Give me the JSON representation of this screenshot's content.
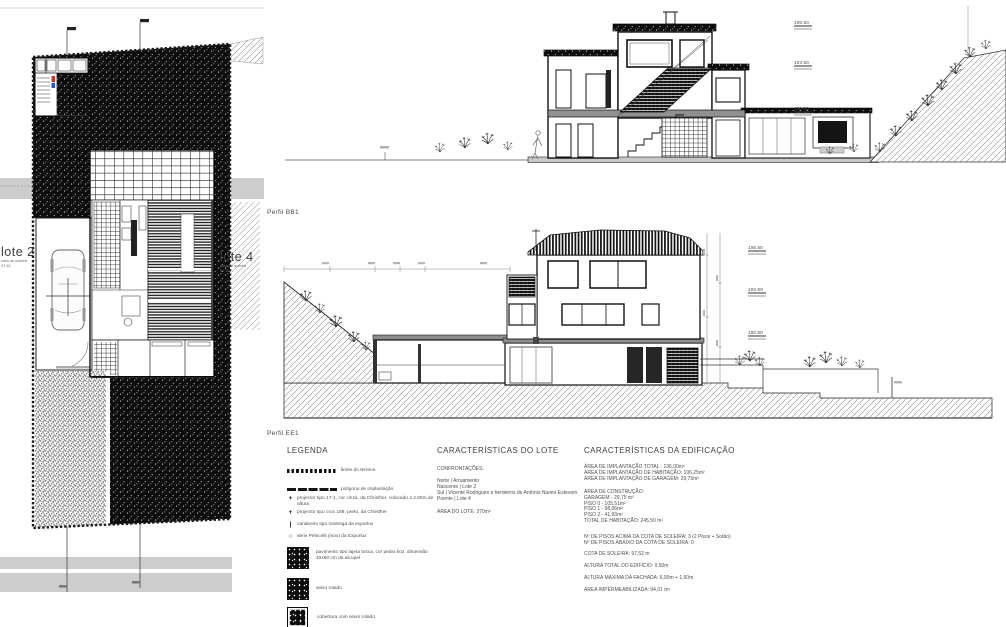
{
  "site_plan": {
    "lote2": {
      "label": "lote 2",
      "sub": "cota de soleira",
      "cota": "97,61"
    },
    "lote4": {
      "label": "lote 4",
      "sub": "cota de soleira",
      "cota": "97,32"
    }
  },
  "profiles": {
    "bb1_label": "Perfil BB1",
    "ee1_label": "Perfil EE1",
    "levels": [
      "106.50",
      "103.50",
      "100.50"
    ]
  },
  "legend": {
    "title": "LEGENDA",
    "items": [
      {
        "symbol": "dashed-line",
        "text": "limite do terreno"
      },
      {
        "symbol": "solid-line",
        "text": "polígono de implantação"
      },
      {
        "symbol": "cross",
        "glyph": "+",
        "text": "projector tipo 17-1, cor cinza, da Christher, colocado a 2.50m de altura"
      },
      {
        "symbol": "cross",
        "glyph": "+",
        "text": "projector tipo croc 188, preto, da Christher"
      },
      {
        "symbol": "bar",
        "glyph": "|",
        "text": "candeeiro tipo mintrega da exporlux"
      },
      {
        "symbol": "circle",
        "glyph": "○",
        "text": "série Pénicelli (inox) da Exporlux"
      },
      {
        "symbol": "stipple-swatch",
        "text": "pavimento tipo lajeta tosca, cor pedra lioz, dimensão 40x60 cm da alcupel"
      },
      {
        "symbol": "stipple-swatch",
        "text": "seixo rolado"
      },
      {
        "symbol": "stipple-swatch-bordered",
        "text": "cobertura com seixo rolado"
      }
    ]
  },
  "lote": {
    "title": "CARACTERÍSTICAS DO LOTE",
    "confrontacoes_label": "CONFRONTAÇÕES:",
    "confrontacoes": [
      "Norte | Arruamento",
      "Nascente | Lote 2",
      "Sul | Vicente Rodrigues e  herdeiros de António Nunes Estevam",
      "Poente | Lote 4"
    ],
    "area": "ÁREA DO LOTE: 370m²"
  },
  "edificacao": {
    "title": "CARACTERÍSTICAS DA EDIFICAÇÃO",
    "implantacao": [
      "ÁREA DE IMPLANTAÇÃO TOTAL : 136,00m²",
      "ÁREA DE IMPLANTAÇÃO DE HABITAÇÃO: 106,25m²",
      "ÁREA DE IMPLANTAÇÃO DE GARAGEM: 29,75m²"
    ],
    "construcao_label": "ÁREA DE CONSTRUÇÃO:",
    "construcao": [
      "GARAGEM - 29,75 m²",
      "PISO 0 - 105,51m²",
      "PISO 1 - 98,06m²",
      "PISO 2 - 41,93m²",
      "TOTAL DE HABITAÇÃO: 245,50 m²"
    ],
    "pisos": [
      "Nº DE PISOS ACIMA DA COTA DE SOLEIRA: 3 (2 Pisos + Sotão)",
      "Nº DE PISOS ABAIXO DA COTA DE SOLEIRA: 0"
    ],
    "cota": "COTA DE SOLEIRA: 97,52 m",
    "altura_total": "ALTURA TOTAL DO EDIFÍCIO: 9,50m",
    "altura_fachada": "ALTURA MÁXIMA DA FACHADA: 6,90m + 1,60m",
    "impermeabilizada": "ÁREA IMPERMEABILIZADA: 94,01 m²"
  },
  "colors": {
    "ink": "#111111",
    "slab_gray": "#8d8d8d",
    "band_gray": "#cdcdcd",
    "stair_red": "#c03a2b",
    "stair_blue": "#2b4fd8"
  }
}
